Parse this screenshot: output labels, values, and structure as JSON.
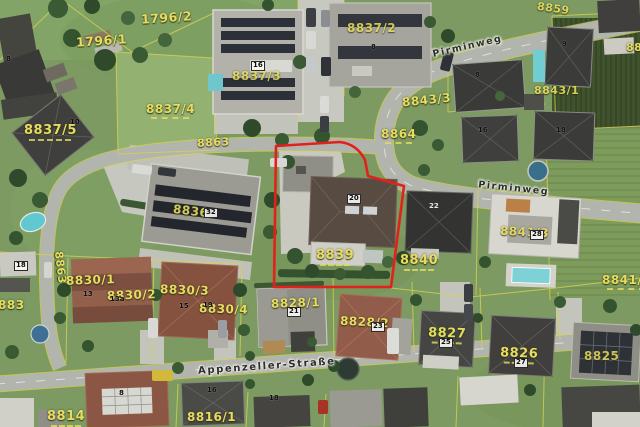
{
  "map": {
    "description": "Aerial orthophoto with cadastral parcel overlay",
    "highlighted_parcel": "8839",
    "highlight_color": "#e3211a",
    "parcel_line_color": "#d9d44e",
    "parcel_label_color": "#e5dc60"
  },
  "streets": {
    "pirminweg_upper": "Pirminweg",
    "pirminweg_lower": "Pirminweg",
    "appenzeller": "Appenzeller-Straße"
  },
  "parcels": {
    "p1796_1": "1796/1",
    "p1796_2": "1796/2",
    "p8837_2": "8837/2",
    "p8837_3": "8837/3",
    "p8837_4": "8837/4",
    "p8837_5": "8837/5",
    "p8859": "8859",
    "p8863_a": "8863",
    "p8863_b": "8863",
    "p8864": "8864",
    "p8843_3": "8843/3",
    "p8843_1": "8843/1",
    "p884x": "88",
    "p8836": "8836",
    "p8839": "8839",
    "p8840": "8840",
    "p8841_1": "8841/1",
    "p8841_3": "8841/3",
    "p8830_1": "8830/1",
    "p8830_2": "8830/2",
    "p8830_3": "8830/3",
    "p8830_4": "8830/4",
    "p883x": "883",
    "p8828_1": "8828/1",
    "p8828_2": "8828/2",
    "p8827": "8827",
    "p8826": "8826",
    "p8825": "8825",
    "p8814": "8814",
    "p8816_1": "8816/1"
  },
  "house_numbers": {
    "h_tl": "8",
    "h8837_3": "16",
    "h8837_2": "8",
    "h8837_5": "10",
    "h_tr": "9",
    "h8836": "32",
    "h8843_3": "8",
    "h_n16": "16",
    "h_n18": "18",
    "h8839": "20",
    "h8840": "22",
    "h8841_3": "28",
    "h8828_1": "21",
    "h8828_2": "23",
    "h8827": "25",
    "h8826": "27",
    "h8830_1a": "13",
    "h8830_1b": "13a",
    "h8830_3a": "15",
    "h8830_3b": "19",
    "h_s16": "16",
    "h_s18": "18",
    "h8814": "8",
    "h_w18": "18"
  }
}
